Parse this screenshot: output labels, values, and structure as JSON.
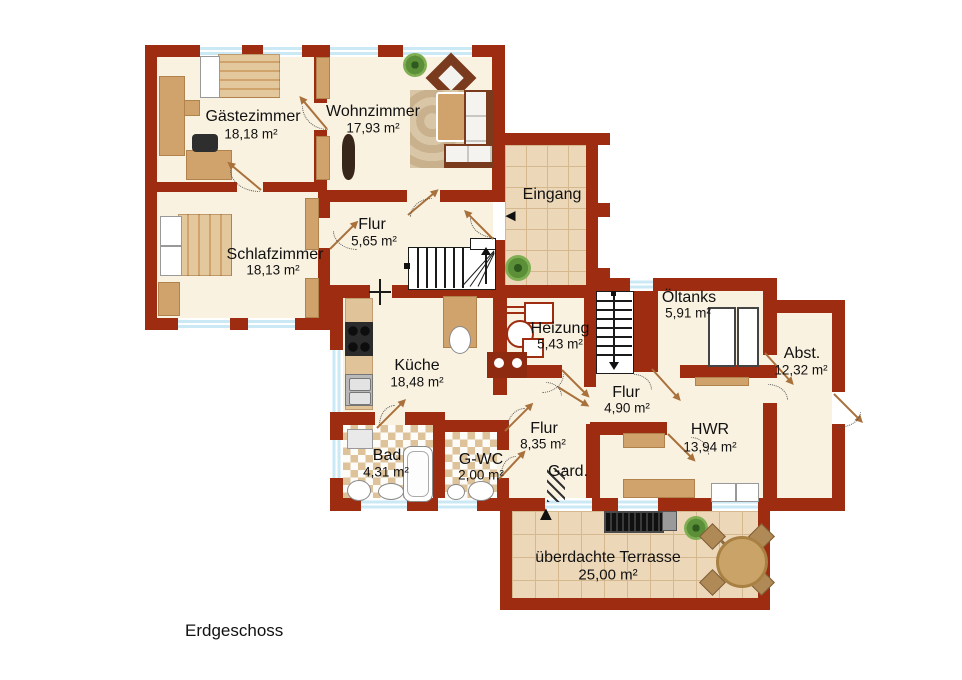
{
  "floor_label": "Erdgeschoss",
  "rooms": {
    "gaestezimmer": {
      "name": "Gästezimmer",
      "area": "18,18 m²"
    },
    "wohnzimmer": {
      "name": "Wohnzimmer",
      "area": "17,93 m²"
    },
    "schlafzimmer": {
      "name": "Schlafzimmer",
      "area": "18,13 m²"
    },
    "flur_og": {
      "name": "Flur",
      "area": "5,65 m²"
    },
    "eingang": {
      "name": "Eingang"
    },
    "heizung": {
      "name": "Heizung",
      "area": "5,43 m²"
    },
    "oeltanks": {
      "name": "Öltanks",
      "area": "5,91 m²"
    },
    "abstellraum": {
      "name": "Abst.",
      "area": "12,32 m²"
    },
    "kueche": {
      "name": "Küche",
      "area": "18,48 m²"
    },
    "flur_mitte": {
      "name": "Flur",
      "area": "4,90 m²"
    },
    "hwr": {
      "name": "HWR",
      "area": "13,94 m²"
    },
    "flur_sued": {
      "name": "Flur",
      "area": "8,35 m²"
    },
    "bad": {
      "name": "Bad",
      "area": "4,31 m²"
    },
    "gwc": {
      "name": "G-WC",
      "area": "2,00 m²"
    },
    "garderobe": {
      "name": "Gard."
    },
    "terrasse": {
      "name": "überdachte Terrasse",
      "area": "25,00 m²"
    }
  },
  "icons": {
    "entrance_arrow": "◄",
    "terrace_entrance_arrow": "▲"
  },
  "colors": {
    "wall": "#9d2c10",
    "floor_cream": "#faf2e1",
    "tile_floor": "#ecd8b9",
    "bath_mosaic": "#f4ead6",
    "window_glass": "#cbe8f5",
    "furniture_tan": "#cfa36b",
    "furniture_dark_brown": "#7a3a1e",
    "door_swing": "#a9713c",
    "text": "#111111"
  }
}
